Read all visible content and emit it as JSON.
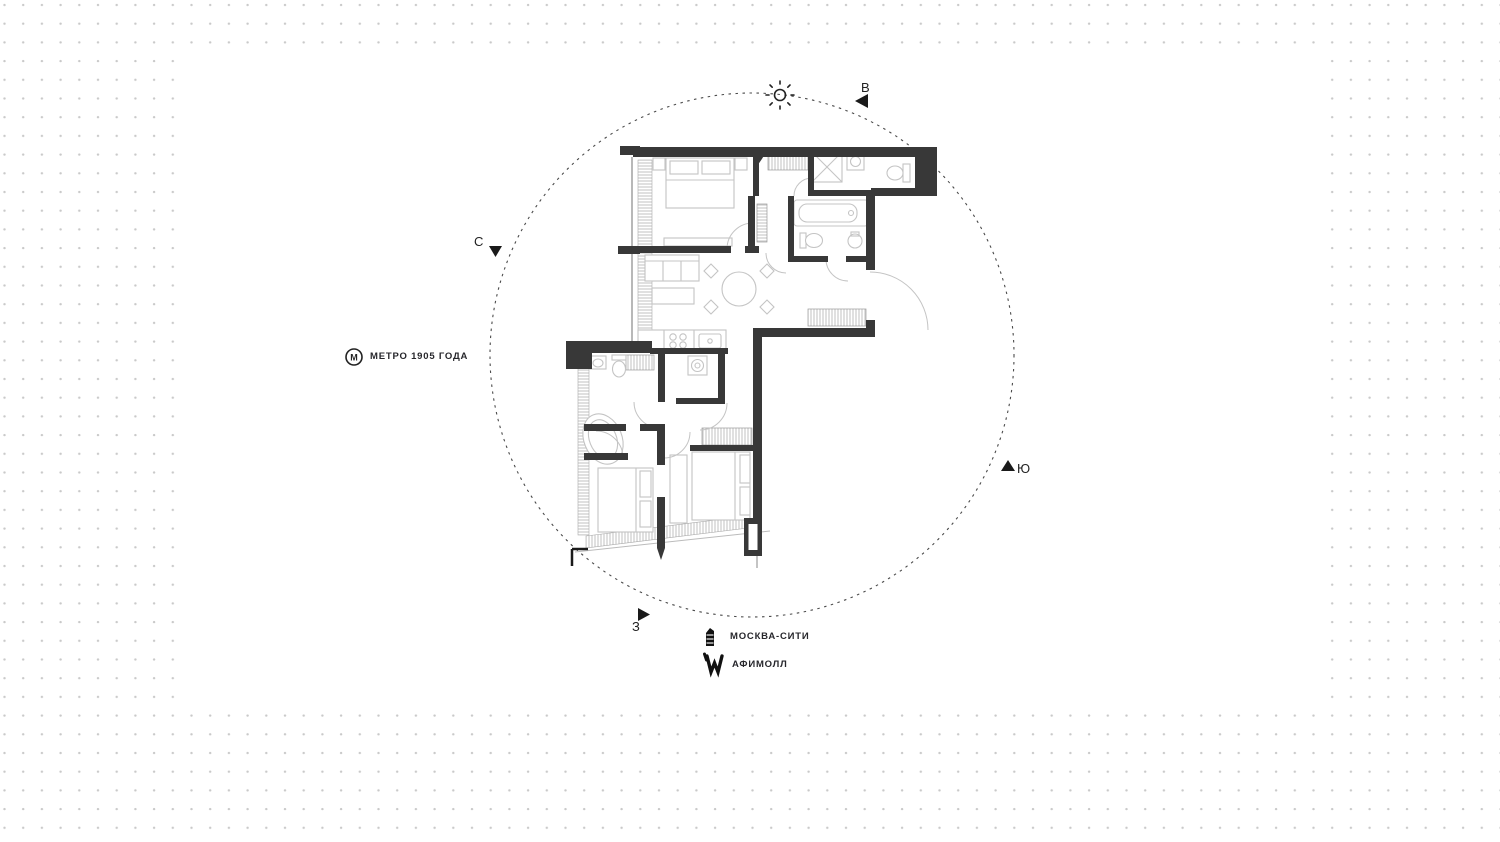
{
  "page": {
    "background": "#ffffff",
    "dot_color": "#c9c9c9",
    "wall_color": "#383838",
    "furniture_color": "#c4c4c4",
    "site_boundary": "dashed-circle"
  },
  "compass": {
    "north": "С",
    "east": "В",
    "south": "Ю",
    "west": "З"
  },
  "landmarks": {
    "metro": {
      "badge": "М",
      "label": "МЕТРО 1905 ГОДА"
    },
    "moscow_city": {
      "label": "МОСКВА-СИТИ"
    },
    "afimall": {
      "label": "АФИМОЛЛ"
    }
  },
  "floor_plan": {
    "type": "apartment-floor-plan",
    "sun_position": "east-top",
    "fixtures": [
      "bed",
      "bed",
      "bed",
      "sofa",
      "coffee-table",
      "round-dining-table",
      "chairs",
      "kitchen-counter",
      "shower-cabin",
      "bathtub",
      "oval-bathtub",
      "toilet",
      "toilet",
      "sink",
      "sink",
      "washing-machine",
      "wardrobe",
      "wardrobe",
      "wardrobe",
      "entry-door-swing",
      "window-glazing"
    ]
  }
}
